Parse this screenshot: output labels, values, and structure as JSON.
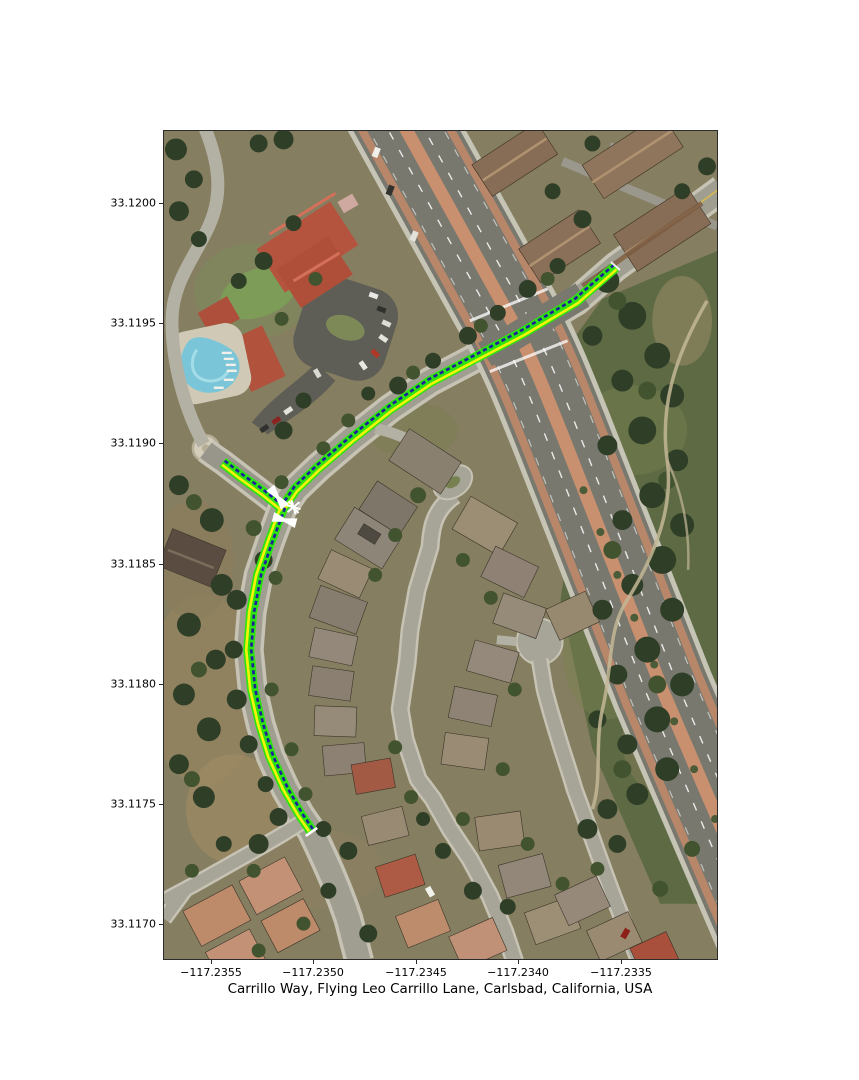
{
  "figure": {
    "title": "Carrillo Way, Flying Leo Carrillo Lane, Carlsbad, California, USA",
    "x_axis": {
      "ticks": [
        "−117.2355",
        "−117.2350",
        "−117.2345",
        "−117.2340",
        "−117.2335"
      ]
    },
    "y_axis": {
      "ticks": [
        "33.1200",
        "33.1195",
        "33.1190",
        "33.1185",
        "33.1180",
        "33.1175",
        "33.1170"
      ]
    },
    "map": {
      "type": "aerial-satellite",
      "place": "Carlsbad, California, USA",
      "streets_highlighted": [
        "Carrillo Way",
        "Flying Leo Carrillo Lane"
      ],
      "route_overlay": {
        "casing_color": "#2ee40e",
        "side_line_color": "#f2f20c",
        "center_line_color": "#1f1f9e",
        "center_line_style": "dashed",
        "junction_marker_color": "#ffffff",
        "endpoints_lonlat": [
          [
            -117.23353,
            33.11974
          ],
          [
            -117.23501,
            33.11738
          ],
          [
            -117.23545,
            33.11892
          ]
        ],
        "junction_lonlat": [
          -117.23515,
          33.11873
        ]
      },
      "arterial_median_color": "#c8906f"
    }
  }
}
